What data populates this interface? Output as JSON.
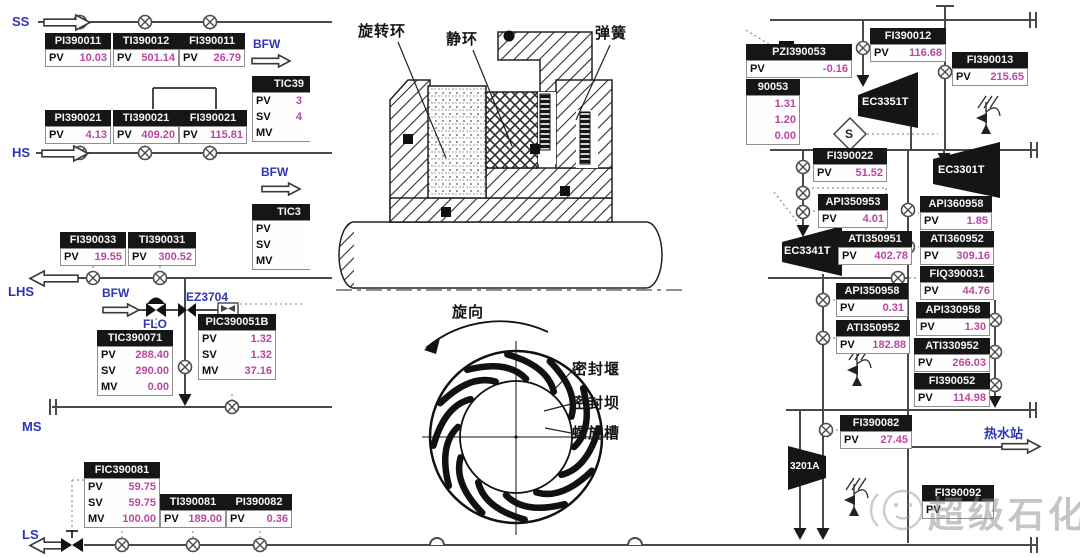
{
  "colors": {
    "value_magenta": "#bb47a1",
    "stream_blue": "#2d35b5",
    "tag_title_bg": "#161616",
    "pipe_line": "#4a4a4a"
  },
  "streams": {
    "ss": "SS",
    "hs": "HS",
    "lhs": "LHS",
    "ms": "MS",
    "ls": "LS",
    "bfw_top": "BFW",
    "bfw_mid": "BFW",
    "bfw_low": "BFW",
    "flo": "FLO",
    "ez3704": "EZ3704",
    "hot_water_station": "热水站"
  },
  "equipment": {
    "ec3351t": "EC3351T",
    "ec3301t": "EC3301T",
    "ec3341t": "EC3341T",
    "ec3201a": "3201A",
    "interlock_s": "S"
  },
  "seal_diagram": {
    "rotating_ring": "旋转环",
    "stationary_ring": "静环",
    "spring": "弹簧",
    "rotation_direction": "旋向",
    "seal_weir": "密封堰",
    "seal_dam": "密封坝",
    "spiral_groove": "螺旋槽"
  },
  "watermark": "超级石化",
  "tags": [
    {
      "id": "PI390011",
      "rows": [
        {
          "label": "PV",
          "value": "10.03"
        }
      ]
    },
    {
      "id": "TI390012",
      "rows": [
        {
          "label": "PV",
          "value": "501.14"
        }
      ]
    },
    {
      "id": "FI390011",
      "rows": [
        {
          "label": "PV",
          "value": "26.79"
        }
      ]
    },
    {
      "id": "TIC39",
      "rows": [
        {
          "label": "PV",
          "value": "3"
        },
        {
          "label": "SV",
          "value": "4"
        },
        {
          "label": "MV",
          "value": ""
        }
      ]
    },
    {
      "id": "PI390021",
      "rows": [
        {
          "label": "PV",
          "value": "4.13"
        }
      ]
    },
    {
      "id": "TI390021",
      "rows": [
        {
          "label": "PV",
          "value": "409.20"
        }
      ]
    },
    {
      "id": "FI390021",
      "rows": [
        {
          "label": "PV",
          "value": "115.81"
        }
      ]
    },
    {
      "id": "TIC3",
      "rows": [
        {
          "label": "PV",
          "value": ""
        },
        {
          "label": "SV",
          "value": ""
        },
        {
          "label": "MV",
          "value": ""
        }
      ]
    },
    {
      "id": "FI390033",
      "rows": [
        {
          "label": "PV",
          "value": "19.55"
        }
      ]
    },
    {
      "id": "TI390031",
      "rows": [
        {
          "label": "PV",
          "value": "300.52"
        }
      ]
    },
    {
      "id": "TIC390071",
      "rows": [
        {
          "label": "PV",
          "value": "288.40"
        },
        {
          "label": "SV",
          "value": "290.00"
        },
        {
          "label": "MV",
          "value": "0.00"
        }
      ]
    },
    {
      "id": "PIC390051B",
      "rows": [
        {
          "label": "PV",
          "value": "1.32"
        },
        {
          "label": "SV",
          "value": "1.32"
        },
        {
          "label": "MV",
          "value": "37.16"
        }
      ]
    },
    {
      "id": "FIC390081",
      "rows": [
        {
          "label": "PV",
          "value": "59.75"
        },
        {
          "label": "SV",
          "value": "59.75"
        },
        {
          "label": "MV",
          "value": "100.00"
        }
      ]
    },
    {
      "id": "TI390081",
      "rows": [
        {
          "label": "PV",
          "value": "189.00"
        }
      ]
    },
    {
      "id": "PI390082",
      "rows": [
        {
          "label": "PV",
          "value": "0.36"
        }
      ]
    },
    {
      "id": "PZI390053",
      "rows": [
        {
          "label": "PV",
          "value": "-0.16"
        }
      ]
    },
    {
      "id": "90053",
      "rows": [
        {
          "label": "",
          "value": "1.31"
        },
        {
          "label": "",
          "value": "1.20"
        },
        {
          "label": "",
          "value": "0.00"
        }
      ]
    },
    {
      "id": "FI390012",
      "rows": [
        {
          "label": "PV",
          "value": "116.68"
        }
      ]
    },
    {
      "id": "FI390013",
      "rows": [
        {
          "label": "PV",
          "value": "215.65"
        }
      ]
    },
    {
      "id": "FI390022",
      "rows": [
        {
          "label": "PV",
          "value": "51.52"
        }
      ]
    },
    {
      "id": "API350953",
      "rows": [
        {
          "label": "PV",
          "value": "4.01"
        }
      ]
    },
    {
      "id": "API360958",
      "rows": [
        {
          "label": "PV",
          "value": "1.85"
        }
      ]
    },
    {
      "id": "ATI350951",
      "rows": [
        {
          "label": "PV",
          "value": "402.78"
        }
      ]
    },
    {
      "id": "ATI360952",
      "rows": [
        {
          "label": "PV",
          "value": "309.16"
        }
      ]
    },
    {
      "id": "FIQ390031",
      "rows": [
        {
          "label": "PV",
          "value": "44.76"
        }
      ]
    },
    {
      "id": "API350958",
      "rows": [
        {
          "label": "PV",
          "value": "0.31"
        }
      ]
    },
    {
      "id": "API330958",
      "rows": [
        {
          "label": "PV",
          "value": "1.30"
        }
      ]
    },
    {
      "id": "ATI350952",
      "rows": [
        {
          "label": "PV",
          "value": "182.88"
        }
      ]
    },
    {
      "id": "ATI330952",
      "rows": [
        {
          "label": "PV",
          "value": "266.03"
        }
      ]
    },
    {
      "id": "FI390052",
      "rows": [
        {
          "label": "PV",
          "value": "114.98"
        }
      ]
    },
    {
      "id": "FI390082",
      "rows": [
        {
          "label": "PV",
          "value": "27.45"
        }
      ]
    },
    {
      "id": "FI390092",
      "rows": [
        {
          "label": "PV",
          "value": ""
        }
      ]
    }
  ]
}
